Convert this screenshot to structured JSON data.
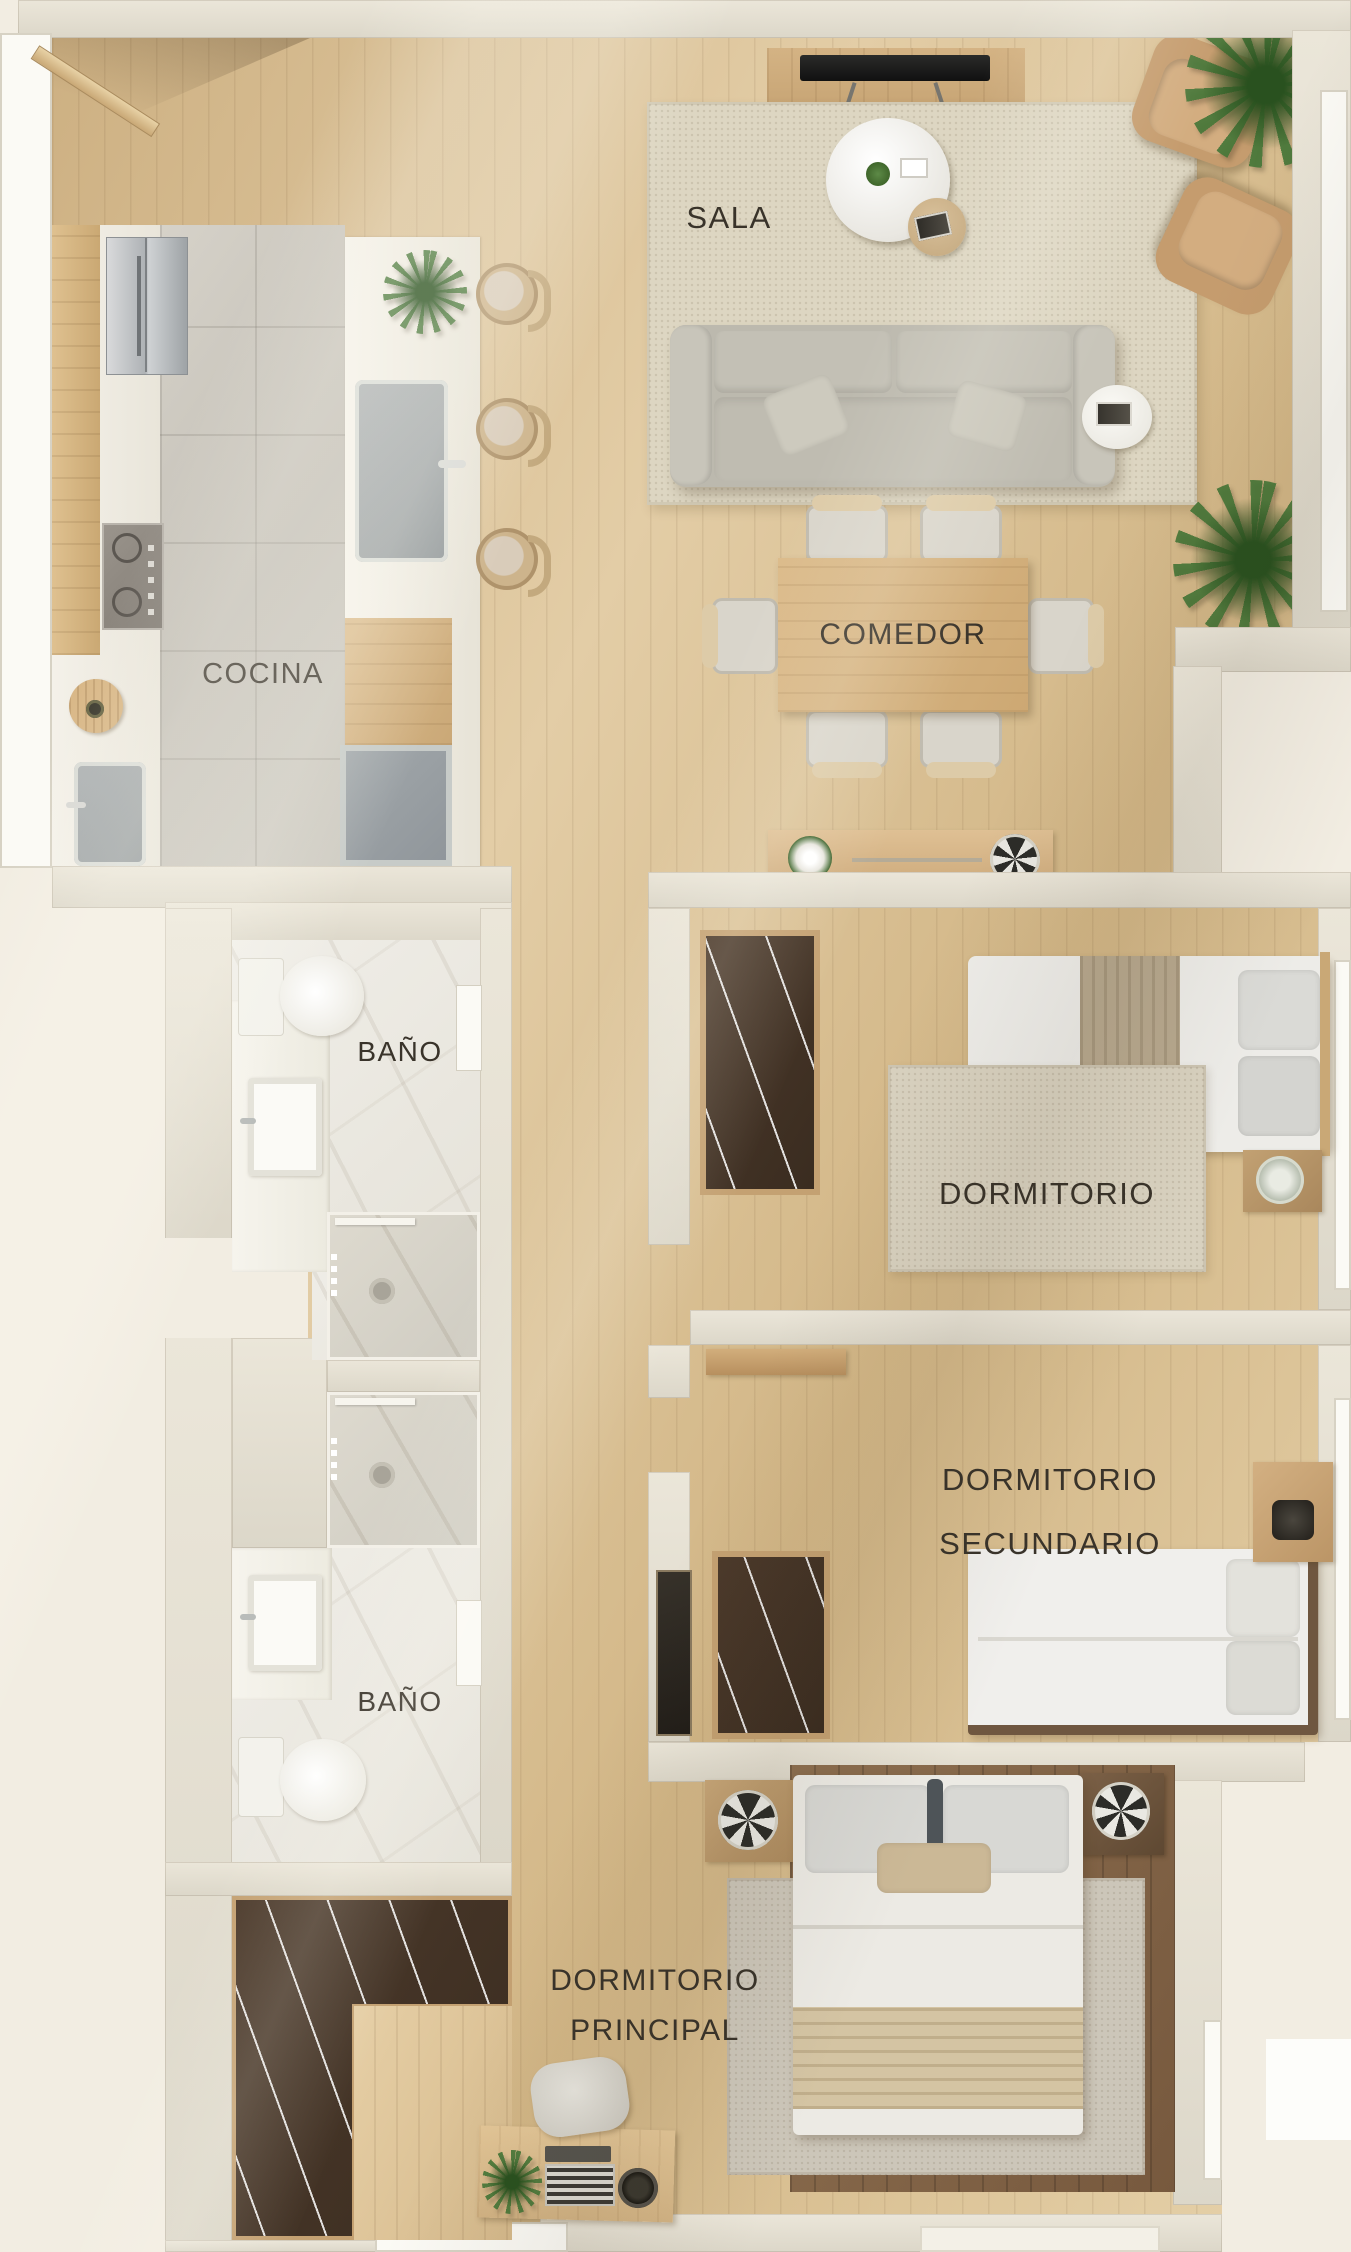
{
  "rooms": {
    "sala": {
      "label": "SALA"
    },
    "cocina": {
      "label": "COCINA"
    },
    "comedor": {
      "label": "COMEDOR"
    },
    "bano_1": {
      "label": "BAÑO"
    },
    "dormitorio": {
      "label": "DORMITORIO"
    },
    "dormitorio_secundario": {
      "label": "DORMITORIO\nSECUNDARIO"
    },
    "bano_2": {
      "label": "BAÑO"
    },
    "dormitorio_principal": {
      "label": "DORMITORIO\nPRINCIPAL"
    }
  },
  "palette": {
    "background": "#f2ede2",
    "wall": "#e4dfd2",
    "wood_floor": "#dcc29a",
    "tile_floor": "#cbc7be",
    "marble": "#edebe4",
    "dark_wood_closet": "#47362a",
    "rug": "#ddd6c3",
    "sofa_gray": "#bcb9ae",
    "armchair_tan": "#c49a6b",
    "plant_green": "#48763a",
    "label_text": "#3a342b"
  }
}
